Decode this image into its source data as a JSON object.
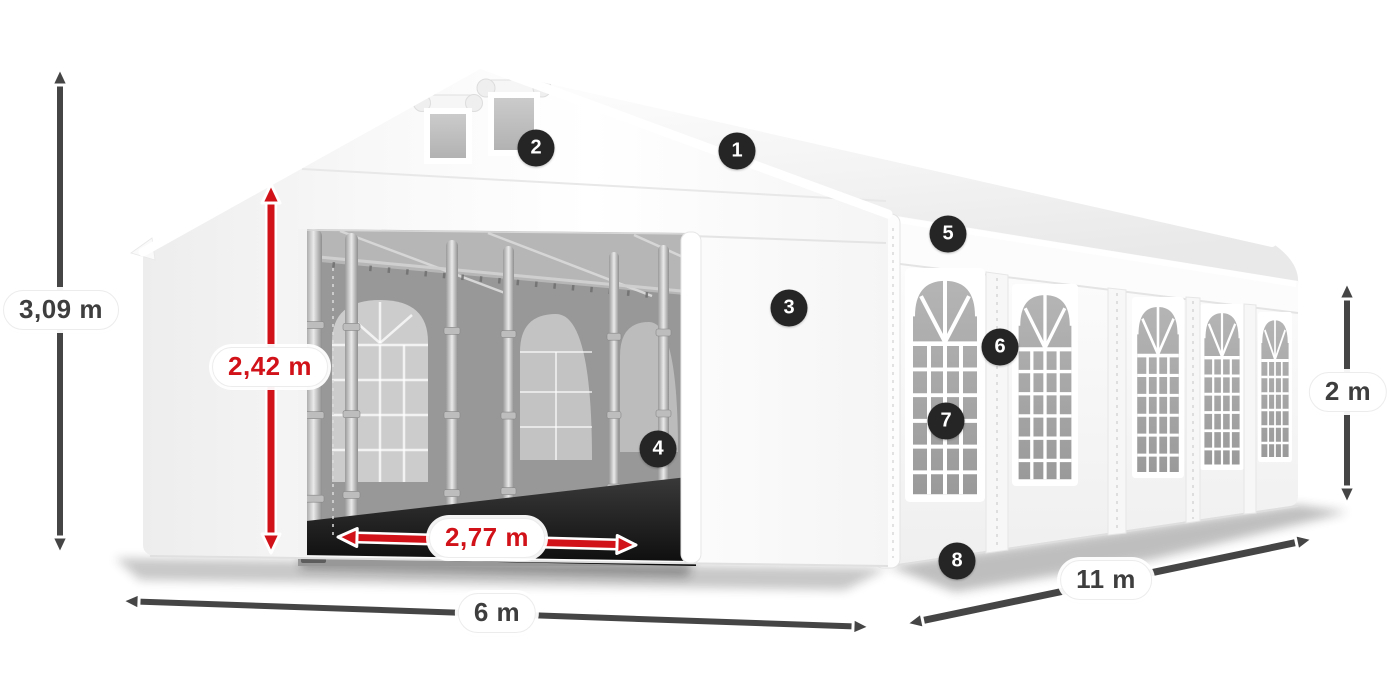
{
  "diagram": {
    "subject": "white-party-tent-3d-view",
    "background": "#ffffff"
  },
  "dimensions": {
    "total_height": {
      "value": "3,09 m",
      "orientation": "vertical",
      "color": "gray",
      "side": "left"
    },
    "door_height": {
      "value": "2,42 m",
      "orientation": "vertical",
      "color": "red",
      "side": "front-door"
    },
    "door_width": {
      "value": "2,77 m",
      "orientation": "horizontal",
      "color": "red",
      "side": "front-door"
    },
    "front_width": {
      "value": "6 m",
      "orientation": "horizontal",
      "color": "gray",
      "side": "bottom-front"
    },
    "side_length": {
      "value": "11 m",
      "orientation": "diagonal",
      "color": "gray",
      "side": "bottom-side"
    },
    "side_wall_height": {
      "value": "2 m",
      "orientation": "vertical",
      "color": "gray",
      "side": "right"
    }
  },
  "callouts": [
    {
      "number": "1",
      "x": 737,
      "y": 151
    },
    {
      "number": "2",
      "x": 536,
      "y": 148
    },
    {
      "number": "3",
      "x": 789,
      "y": 308
    },
    {
      "number": "4",
      "x": 658,
      "y": 449
    },
    {
      "number": "5",
      "x": 948,
      "y": 234
    },
    {
      "number": "6",
      "x": 1000,
      "y": 347
    },
    {
      "number": "7",
      "x": 946,
      "y": 421
    },
    {
      "number": "8",
      "x": 957,
      "y": 561
    }
  ],
  "colors": {
    "dimension_gray": "#454545",
    "dimension_red": "#d11219",
    "badge_background": "#252525",
    "badge_text": "#ffffff"
  }
}
